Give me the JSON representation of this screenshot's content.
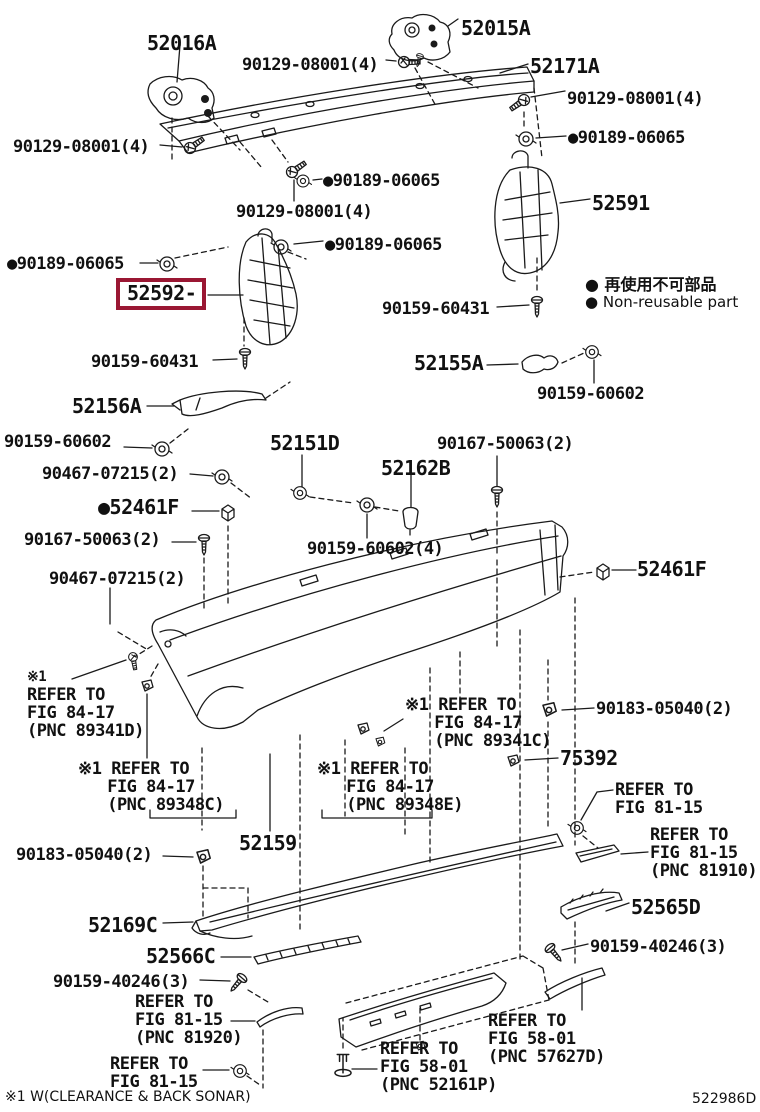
{
  "page": {
    "background": "#ffffff",
    "line_color": "#1a1a1a",
    "highlight_box_color": "#9a1733"
  },
  "highlighted_part": "52592",
  "legend": {
    "line1": "● 再使用不可部品",
    "line2": "● Non-reusable part"
  },
  "footnote": "※1 W(CLEARANCE & BACK SONAR)",
  "diagram_code": "522986D",
  "labels": [
    {
      "id": "52016a",
      "text": "52016A",
      "x": 147,
      "y": 33,
      "size": "lg",
      "clickable": true
    },
    {
      "id": "90129-08001-top",
      "text": "90129-08001(4)",
      "x": 242,
      "y": 56,
      "size": "md",
      "clickable": true
    },
    {
      "id": "52015a",
      "text": "52015A",
      "x": 461,
      "y": 18,
      "size": "lg",
      "clickable": true
    },
    {
      "id": "52171a",
      "text": "52171A",
      "x": 530,
      "y": 56,
      "size": "lg",
      "clickable": true
    },
    {
      "id": "90129-08001-right",
      "text": "90129-08001(4)",
      "x": 567,
      "y": 90,
      "size": "md",
      "clickable": true
    },
    {
      "id": "90189-06065-right-top",
      "text": "●90189-06065",
      "x": 568,
      "y": 129,
      "size": "md",
      "clickable": true
    },
    {
      "id": "90129-08001-left",
      "text": "90129-08001(4)",
      "x": 13,
      "y": 138,
      "size": "md",
      "clickable": true
    },
    {
      "id": "90189-06065-mid-top",
      "text": "●90189-06065",
      "x": 323,
      "y": 172,
      "size": "md",
      "clickable": true
    },
    {
      "id": "90129-08001-mid",
      "text": "90129-08001(4)",
      "x": 236,
      "y": 203,
      "size": "md",
      "clickable": true
    },
    {
      "id": "52591",
      "text": "52591",
      "x": 592,
      "y": 193,
      "size": "lg",
      "clickable": true
    },
    {
      "id": "90189-06065-left",
      "text": "●90189-06065",
      "x": 7,
      "y": 255,
      "size": "md",
      "clickable": true
    },
    {
      "id": "90189-06065-mid",
      "text": "●90189-06065",
      "x": 325,
      "y": 236,
      "size": "md",
      "clickable": true
    },
    {
      "id": "52592",
      "text": "52592-",
      "x": 116,
      "y": 278,
      "size": "lg",
      "clickable": true,
      "boxed": true
    },
    {
      "id": "90159-60431-right",
      "text": "90159-60431",
      "x": 382,
      "y": 300,
      "size": "md",
      "clickable": true
    },
    {
      "id": "90159-60431-left",
      "text": "90159-60431",
      "x": 91,
      "y": 353,
      "size": "md",
      "clickable": true
    },
    {
      "id": "52155a",
      "text": "52155A",
      "x": 414,
      "y": 353,
      "size": "lg",
      "clickable": true
    },
    {
      "id": "90159-60602-right",
      "text": "90159-60602",
      "x": 537,
      "y": 385,
      "size": "md",
      "clickable": true
    },
    {
      "id": "52156a",
      "text": "52156A",
      "x": 72,
      "y": 396,
      "size": "lg",
      "clickable": true
    },
    {
      "id": "90159-60602-left",
      "text": "90159-60602",
      "x": 4,
      "y": 433,
      "size": "md",
      "clickable": true
    },
    {
      "id": "90467-07215-top",
      "text": "90467-07215(2)",
      "x": 42,
      "y": 465,
      "size": "md",
      "clickable": true
    },
    {
      "id": "52151d",
      "text": "52151D",
      "x": 270,
      "y": 433,
      "size": "lg",
      "clickable": true
    },
    {
      "id": "90167-50063-right",
      "text": "90167-50063(2)",
      "x": 437,
      "y": 435,
      "size": "md",
      "clickable": true
    },
    {
      "id": "52461f-left",
      "text": "●52461F",
      "x": 98,
      "y": 497,
      "size": "lg",
      "clickable": true
    },
    {
      "id": "52162b",
      "text": "52162B",
      "x": 381,
      "y": 458,
      "size": "lg",
      "clickable": true
    },
    {
      "id": "90167-50063-left",
      "text": "90167-50063(2)",
      "x": 24,
      "y": 531,
      "size": "md",
      "clickable": true
    },
    {
      "id": "90159-60602-4",
      "text": "90159-60602(4)",
      "x": 307,
      "y": 540,
      "size": "md",
      "clickable": true
    },
    {
      "id": "90467-07215-bot",
      "text": "90467-07215(2)",
      "x": 49,
      "y": 570,
      "size": "md",
      "clickable": true
    },
    {
      "id": "52461f-right",
      "text": "52461F",
      "x": 637,
      "y": 559,
      "size": "lg",
      "clickable": true
    },
    {
      "id": "fn-89341d-mark",
      "text": "※1",
      "x": 27,
      "y": 670,
      "size": "xs",
      "clickable": false
    },
    {
      "id": "ref-89341d",
      "text": "REFER TO\nFIG 84-17\n(PNC 89341D)",
      "x": 27,
      "y": 686,
      "size": "md",
      "clickable": false
    },
    {
      "id": "ref-89341c",
      "text": "※1 REFER TO\n   FIG 84-17\n   (PNC 89341C)",
      "x": 405,
      "y": 696,
      "size": "md",
      "clickable": false
    },
    {
      "id": "90183-05040-right",
      "text": "90183-05040(2)",
      "x": 596,
      "y": 700,
      "size": "md",
      "clickable": true
    },
    {
      "id": "ref-89348c",
      "text": "※1 REFER TO\n   FIG 84-17\n   (PNC 89348C)",
      "x": 78,
      "y": 760,
      "size": "md",
      "clickable": false
    },
    {
      "id": "ref-89348e",
      "text": "※1 REFER TO\n   FIG 84-17\n   (PNC 89348E)",
      "x": 317,
      "y": 760,
      "size": "md",
      "clickable": false
    },
    {
      "id": "75392",
      "text": "75392",
      "x": 560,
      "y": 748,
      "size": "lg",
      "clickable": true
    },
    {
      "id": "ref-8115-top",
      "text": "REFER TO\nFIG 81-15",
      "x": 615,
      "y": 781,
      "size": "md",
      "clickable": false
    },
    {
      "id": "52159",
      "text": "52159",
      "x": 239,
      "y": 833,
      "size": "lg",
      "clickable": true
    },
    {
      "id": "ref-81910",
      "text": "REFER TO\nFIG 81-15\n(PNC 81910)",
      "x": 650,
      "y": 826,
      "size": "md",
      "clickable": false
    },
    {
      "id": "90183-05040-left",
      "text": "90183-05040(2)",
      "x": 16,
      "y": 846,
      "size": "md",
      "clickable": true
    },
    {
      "id": "52565d",
      "text": "52565D",
      "x": 631,
      "y": 897,
      "size": "lg",
      "clickable": true
    },
    {
      "id": "52169c",
      "text": "52169C",
      "x": 88,
      "y": 915,
      "size": "lg",
      "clickable": true
    },
    {
      "id": "90159-40246-right",
      "text": "90159-40246(3)",
      "x": 590,
      "y": 938,
      "size": "md",
      "clickable": true
    },
    {
      "id": "52566c",
      "text": "52566C",
      "x": 146,
      "y": 946,
      "size": "lg",
      "clickable": true
    },
    {
      "id": "90159-40246-left",
      "text": "90159-40246(3)",
      "x": 53,
      "y": 973,
      "size": "md",
      "clickable": true
    },
    {
      "id": "ref-81920",
      "text": "REFER TO\nFIG 81-15\n(PNC 81920)",
      "x": 135,
      "y": 993,
      "size": "md",
      "clickable": false
    },
    {
      "id": "ref-57627d",
      "text": "REFER TO\nFIG 58-01\n(PNC 57627D)",
      "x": 488,
      "y": 1012,
      "size": "md",
      "clickable": false
    },
    {
      "id": "ref-8115-bot",
      "text": "REFER TO\nFIG 81-15",
      "x": 110,
      "y": 1055,
      "size": "md",
      "clickable": false
    },
    {
      "id": "ref-52161p",
      "text": "REFER TO\nFIG 58-01\n(PNC 52161P)",
      "x": 380,
      "y": 1040,
      "size": "md",
      "clickable": false
    }
  ]
}
